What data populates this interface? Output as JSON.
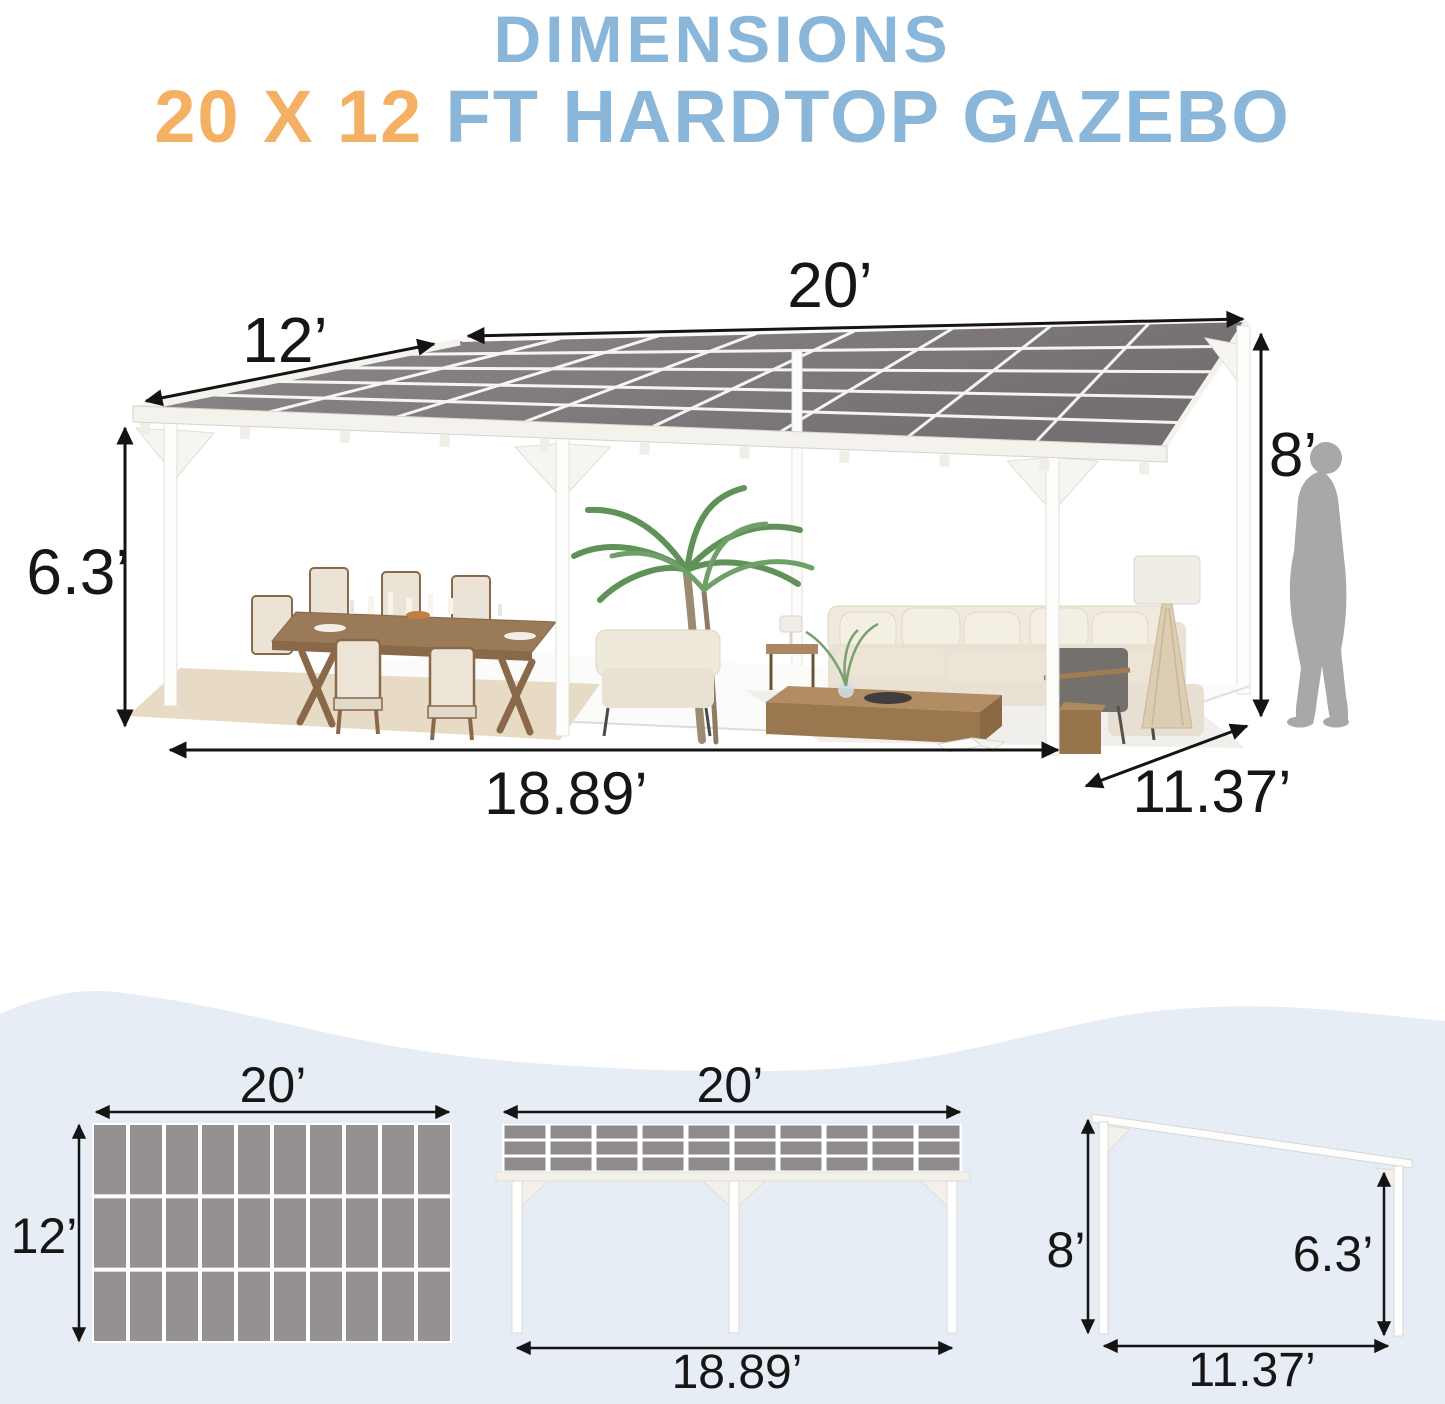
{
  "title": {
    "line1": "DIMENSIONS",
    "line2_accent": "20 X 12",
    "line2_rest": "FT HARDTOP GAZEBO"
  },
  "main_view": {
    "top_width": "20’",
    "depth": "12’",
    "back_height": "8’",
    "front_height": "6.3’",
    "base_width": "18.89’",
    "base_depth": "11.37’"
  },
  "top_view": {
    "width": "20’",
    "depth": "12’"
  },
  "front_view": {
    "width": "20’",
    "base_width": "18.89’"
  },
  "side_view": {
    "back_height": "8’",
    "front_height": "6.3’",
    "base_depth": "11.37’"
  },
  "colors": {
    "accent_blue": "#8AB6D9",
    "accent_orange": "#F4B164",
    "dimension_ink": "#161616",
    "panel_gray": "#959092",
    "roof_gray": "#827C7E",
    "wave_background": "#E6EDF4",
    "structure_white": "#FFFFFF",
    "silhouette_gray": "#A8A8A8",
    "wood_brown": "#9B7A58",
    "cushion_cream": "#EAE3D5"
  }
}
